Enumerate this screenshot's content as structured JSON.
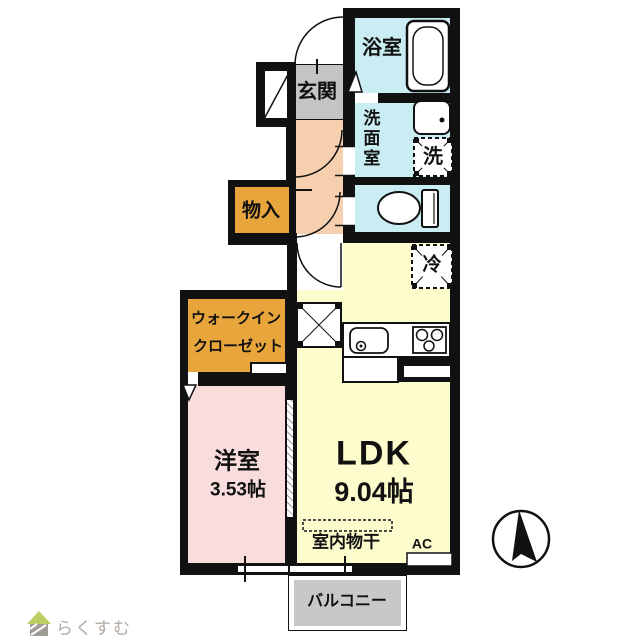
{
  "canvas": {
    "width": 640,
    "height": 640,
    "background": "#ffffff"
  },
  "colors": {
    "wall": "#111111",
    "wet_area": "#c9edf3",
    "entrance": "#c4c4c4",
    "hallway": "#f6d0ae",
    "storage": "#e8a53c",
    "bedroom": "#f9dcdc",
    "ldk": "#fcfccd",
    "balcony": "#c8c8c8",
    "logo_roof": "#b5c647",
    "logo_body": "#8f8a85",
    "logo_text": "#b2a9a1"
  },
  "rooms": {
    "bath": {
      "label": "浴室"
    },
    "entrance": {
      "label": "玄関"
    },
    "washroom": {
      "label": "洗面室"
    },
    "washer": {
      "label": "洗"
    },
    "storage": {
      "label": "物入"
    },
    "fridge": {
      "label": "冷"
    },
    "walk_in_closet": {
      "label_line1": "ウォークイン",
      "label_line2": "クローゼット"
    },
    "bedroom": {
      "label": "洋室",
      "size": "3.53帖"
    },
    "ldk": {
      "label": "LDK",
      "size": "9.04帖"
    },
    "indoor_drying": {
      "label": "室内物干"
    },
    "ac": {
      "label": "AC"
    },
    "balcony": {
      "label": "バルコニー"
    }
  },
  "icons": [
    "bathtub-icon",
    "washbasin-icon",
    "washing-machine-icon",
    "toilet-icon",
    "kitchen-sink-icon",
    "stove-icon",
    "refrigerator-icon",
    "folding-door-icon",
    "door-swing-arc",
    "north-arrow-icon",
    "house-icon"
  ],
  "footer": {
    "logo_text": "らくすむ"
  }
}
